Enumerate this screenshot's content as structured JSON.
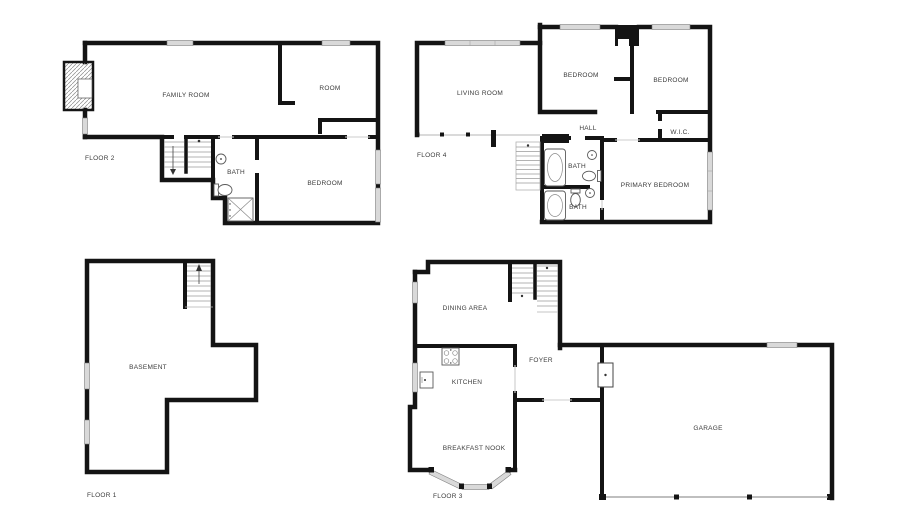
{
  "colors": {
    "wall": "#141414",
    "window_fill": "#d9d9d9",
    "background": "#ffffff",
    "label_text": "#3b3b3b"
  },
  "floors": {
    "floor2": {
      "label": "FLOOR 2",
      "family_room": "FAMILY ROOM",
      "room": "ROOM",
      "bath": "BATH",
      "bedroom": "BEDROOM"
    },
    "floor4": {
      "label": "FLOOR 4",
      "living_room": "LIVING ROOM",
      "bedroom_left": "BEDROOM",
      "bedroom_right": "BEDROOM",
      "hall": "HALL",
      "wic": "W.I.C.",
      "bath_upper": "BATH",
      "bath_lower": "BATH",
      "primary_bedroom": "PRIMARY BEDROOM"
    },
    "floor1": {
      "label": "FLOOR 1",
      "basement": "BASEMENT"
    },
    "floor3": {
      "label": "FLOOR 3",
      "dining_area": "DINING AREA",
      "kitchen": "KITCHEN",
      "foyer": "FOYER",
      "breakfast_nook": "BREAKFAST NOOK",
      "garage": "GARAGE"
    }
  }
}
